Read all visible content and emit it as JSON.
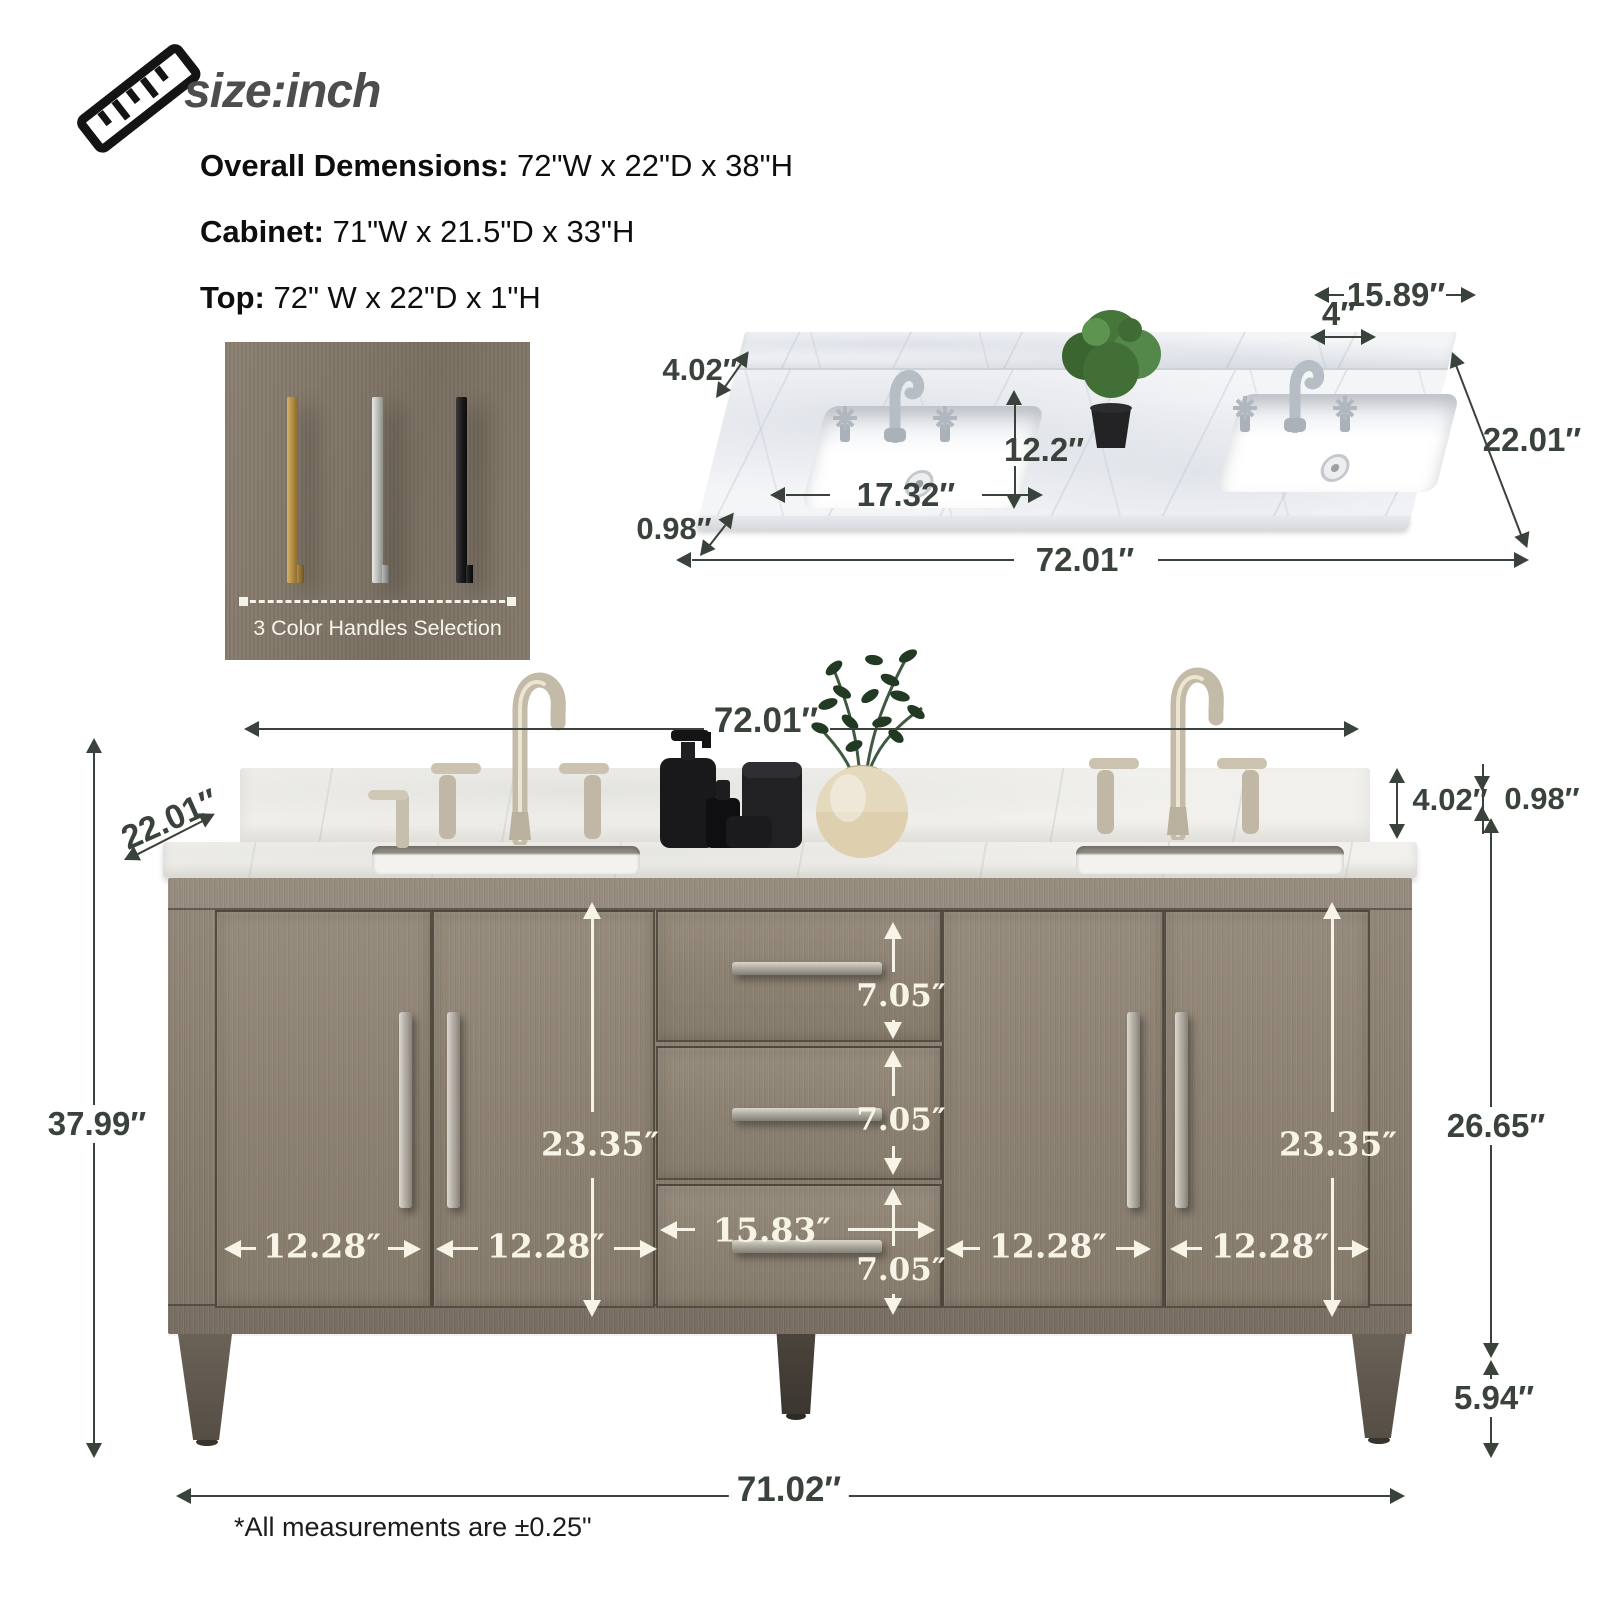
{
  "header": {
    "size_label": "size:inch",
    "specs": [
      {
        "label": "Overall Demensions:",
        "value": " 72\"W x 22\"D x 38\"H"
      },
      {
        "label": "Cabinet:",
        "value": " 71\"W x 21.5\"D x 33\"H"
      },
      {
        "label": "Top:",
        "value": " 72\" W x 22\"D x 1\"H"
      }
    ]
  },
  "handles_card": {
    "caption": "3 Color Handles Selection",
    "handle_colors": {
      "gold": "#b8944e",
      "silver": "#c7c7c3",
      "black": "#1d1d1f"
    }
  },
  "countertop": {
    "dims": {
      "sink_center_spread": "15.89″",
      "faucet_hole_spread": "4″",
      "backsplash_height": "4.02″",
      "depth": "22.01″",
      "sink_front_depth": "12.2″",
      "sink_width": "17.32″",
      "top_thickness": "0.98″",
      "width": "72.01″"
    }
  },
  "vanity": {
    "dims": {
      "top_width": "72.01″",
      "depth": "22.01″",
      "backsplash_height": "4.02″",
      "top_thickness": "0.98″",
      "overall_height": "37.99″",
      "left_door_opening_height": "23.35″",
      "right_door_opening_height": "23.35″",
      "drawer_heights": [
        "7.05″",
        "7.05″",
        "7.05″"
      ],
      "drawer_width": "15.83″",
      "door_widths": [
        "12.28″",
        "12.28″",
        "12.28″",
        "12.28″"
      ],
      "cabinet_body_height": "26.65″",
      "leg_height": "5.94″",
      "base_width": "71.02″"
    }
  },
  "footnote": "*All measurements are ±0.25\"",
  "colors": {
    "dim_dark": "#39423b",
    "dim_light": "#f7f3e6",
    "wood": "#8b8071",
    "marble": "#f4f5f7"
  }
}
